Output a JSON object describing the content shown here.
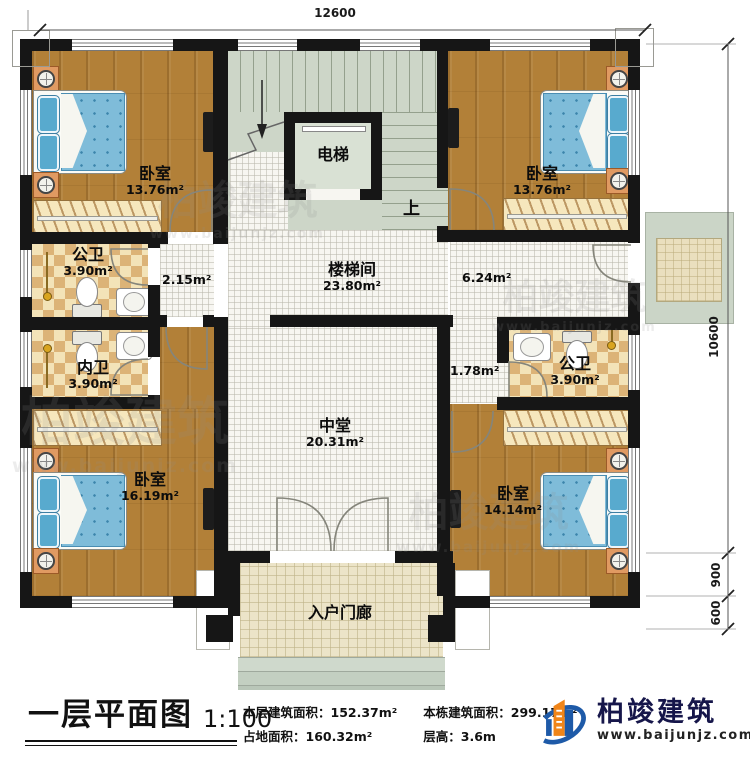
{
  "dimensions": {
    "width_top": "12600",
    "height_right": "10600",
    "porch_depth": "900",
    "steps_depth": "600"
  },
  "rooms": {
    "bedroom_top_left": {
      "name": "卧室",
      "area": "13.76m²"
    },
    "bedroom_top_right": {
      "name": "卧室",
      "area": "13.76m²"
    },
    "elevator": {
      "name": "电梯"
    },
    "stairwell": {
      "name": "楼梯间",
      "area": "23.80m²"
    },
    "bath_public_left": {
      "name": "公卫",
      "area": "3.90m²"
    },
    "bath_private_left": {
      "name": "内卫",
      "area": "3.90m²"
    },
    "bath_public_right": {
      "name": "公卫",
      "area": "3.90m²"
    },
    "central_hall": {
      "name": "中堂",
      "area": "20.31m²"
    },
    "bedroom_bottom_left": {
      "name": "卧室",
      "area": "16.19m²"
    },
    "bedroom_bottom_right": {
      "name": "卧室",
      "area": "14.14m²"
    },
    "entry_porch": {
      "name": "入户门廊"
    }
  },
  "passages": {
    "corridor_left": "2.15m²",
    "corridor_right": "6.24m²",
    "corridor_small": "1.78m²",
    "stairs_up": "上"
  },
  "footer": {
    "title": "一层平面图",
    "scale": "1:100",
    "stats": [
      {
        "label": "本层建筑面积：",
        "value": "152.37m²"
      },
      {
        "label": "占地面积：",
        "value": "160.32m²"
      },
      {
        "label": "本栋建筑面积：",
        "value": "299.17m²"
      },
      {
        "label": "层高：",
        "value": "3.6m"
      }
    ],
    "brand": "柏竣建筑",
    "website": "www.baijunjz.com"
  },
  "watermark": {
    "text": "柏竣建筑",
    "website": "www.baijunjz.com"
  },
  "colors": {
    "wall": "#161616",
    "wood": "#b28038",
    "tile_light": "#f3e3b8",
    "tile_dark": "#dcb377",
    "stair": "#cdd6c8",
    "accent_blue": "#1e5aa8",
    "accent_orange": "#f08519"
  }
}
